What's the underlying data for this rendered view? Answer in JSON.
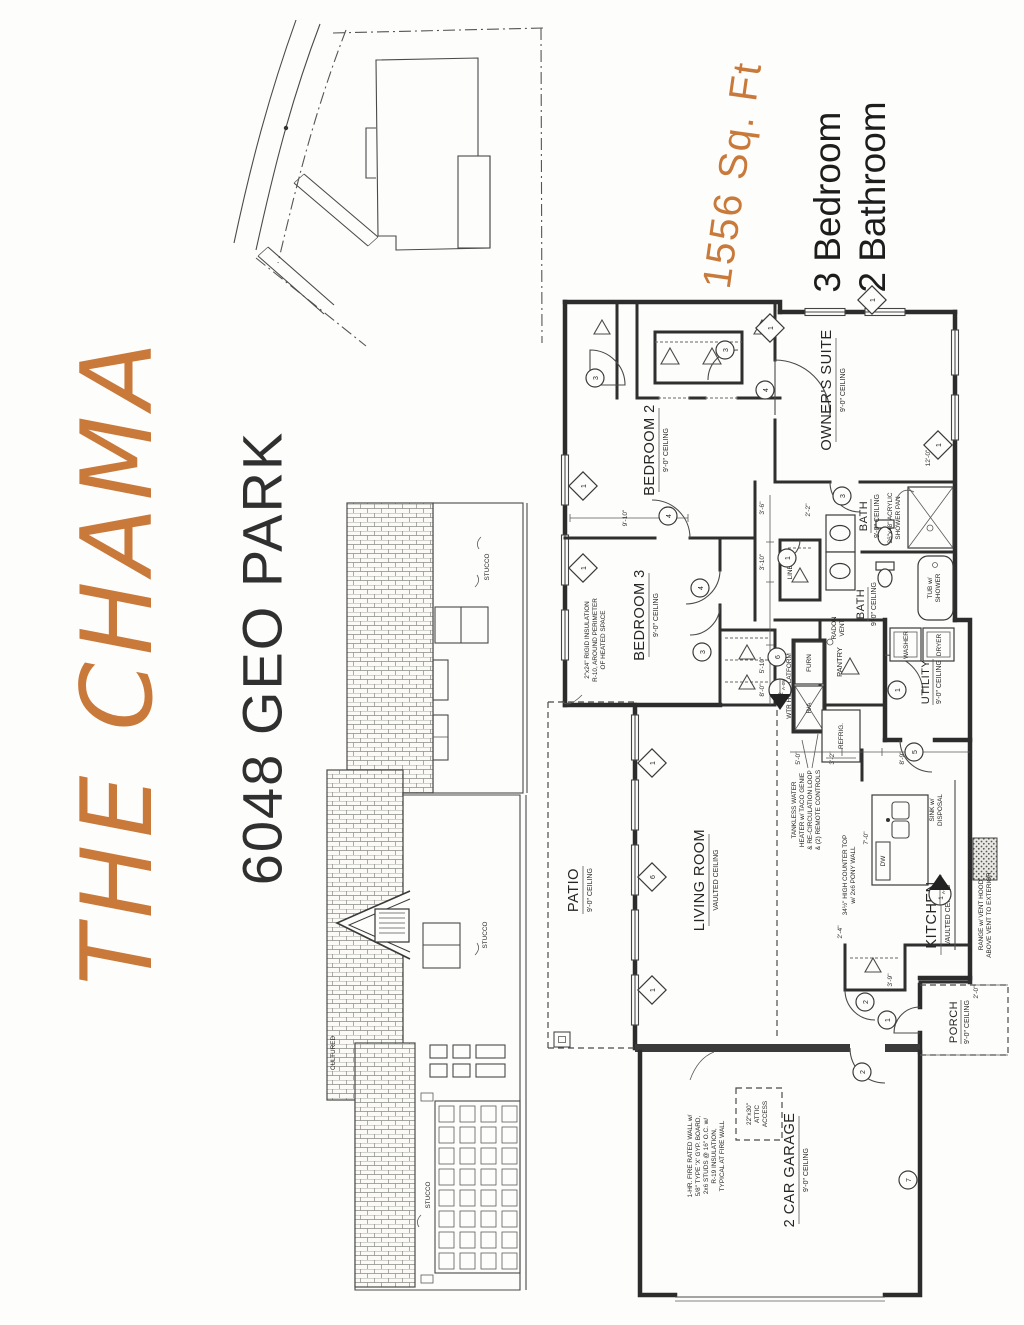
{
  "branding": {
    "plan_name": "THE CHAMA",
    "address": "6048 GEO PARK",
    "sqft": "1556 Sq. Ft",
    "bedrooms": "3 Bedroom",
    "bathrooms": "2 Bathroom",
    "accent_color": "#c9793a",
    "ink_color": "#2c2c2c"
  },
  "rooms": {
    "owners_suite": {
      "name": "OWNER'S SUITE",
      "ceiling": "9'-0\" CEILING"
    },
    "bedroom2": {
      "name": "BEDROOM 2",
      "ceiling": "9'-0\" CEILING"
    },
    "bedroom3": {
      "name": "BEDROOM 3",
      "ceiling": "9'-0\" CEILING"
    },
    "bath1": {
      "name": "BATH",
      "ceiling": "9'-0\" CEILING"
    },
    "bath2": {
      "name": "BATH",
      "ceiling": "9'-0\" CEILING"
    },
    "living": {
      "name": "LIVING ROOM",
      "ceiling": "VAULTED CEILING"
    },
    "kitchen": {
      "name": "KITCHEN",
      "ceiling": "VAULTED CEILING"
    },
    "patio": {
      "name": "PATIO",
      "ceiling": "9'-0\" CEILING"
    },
    "porch": {
      "name": "PORCH",
      "ceiling": "9'-0\" CEILING"
    },
    "utility": {
      "name": "UTILITY",
      "ceiling": "9'-0\" CEILING"
    },
    "garage": {
      "name": "2 CAR GARAGE",
      "ceiling": "9'-0\" CEILING"
    },
    "linen": "LINEN",
    "pantry": "PANTRY"
  },
  "fixtures": {
    "washer": "WASHER",
    "dryer": "DRYER",
    "furnace": "FURN",
    "return_air": "R/A",
    "refrigerator": "REFRIG.",
    "dishwasher": "DW",
    "tub": [
      "TUB w/",
      "SHOWER"
    ],
    "sink": [
      "SINK w/",
      "DISPOSAL"
    ],
    "platform": "WTR HTR PLATFORM",
    "radon": [
      "RADON",
      "VENT"
    ]
  },
  "annotations": {
    "insulation": [
      "2\"x24\" RIGID INSULATION",
      "R-10, AROUND PERIMETER",
      "OF HEATED SPACE"
    ],
    "tankless": [
      "TANKLESS WATER",
      "HEATER w/ TACO GENIE",
      "& RE-CIRCULATION LOOP",
      "& (2) REMOTE CONTROLS"
    ],
    "counter": [
      "34½\" HIGH COUNTER TOP",
      "w/ 2x6 PONY WALL"
    ],
    "shower_pan": [
      "36\"x48\" ACRYLIC",
      "SHOWER PAN"
    ],
    "range": [
      "RANGE w/ VENT HOOD",
      "ABOVE VENT TO EXTERIOR"
    ],
    "attic": [
      "22\"x30\"",
      "ATTIC",
      "ACCESS"
    ],
    "firewall": [
      "1-HR. FIRE RATED WALL w/",
      "5/8\" TYPE 'X' GYP. BOARD,",
      "2x6 STUDS @ 16\" O.C. w/",
      "R-19 INSULATION,",
      "TYPICAL AT FIRE WALL"
    ]
  },
  "elevation_labels": {
    "stucco": "STUCCO",
    "cultured": "CULTURED"
  },
  "dimensions": [
    "9'-10\"",
    "3'-6\"",
    "3'-10\"",
    "5'-10\"",
    "8'-0\"",
    "2'-2\"",
    "12'-0\"",
    "7'-0\"",
    "5'-0\"",
    "3'-2\"",
    "8'-9\"",
    "2'-4\"",
    "3'-9\"",
    "2'-0\""
  ],
  "markers": {
    "windows": [
      "1",
      "1",
      "1",
      "6",
      "1",
      "1",
      "1",
      "1"
    ],
    "doors": [
      "3",
      "3",
      "4",
      "4",
      "4",
      "3",
      "3",
      "1",
      "1",
      "5",
      "2",
      "1",
      "2",
      "7",
      "6"
    ],
    "sections": [
      {
        "num": "1",
        "sheet": "A-05"
      },
      {
        "num": "2",
        "sheet": "A-05"
      }
    ]
  }
}
